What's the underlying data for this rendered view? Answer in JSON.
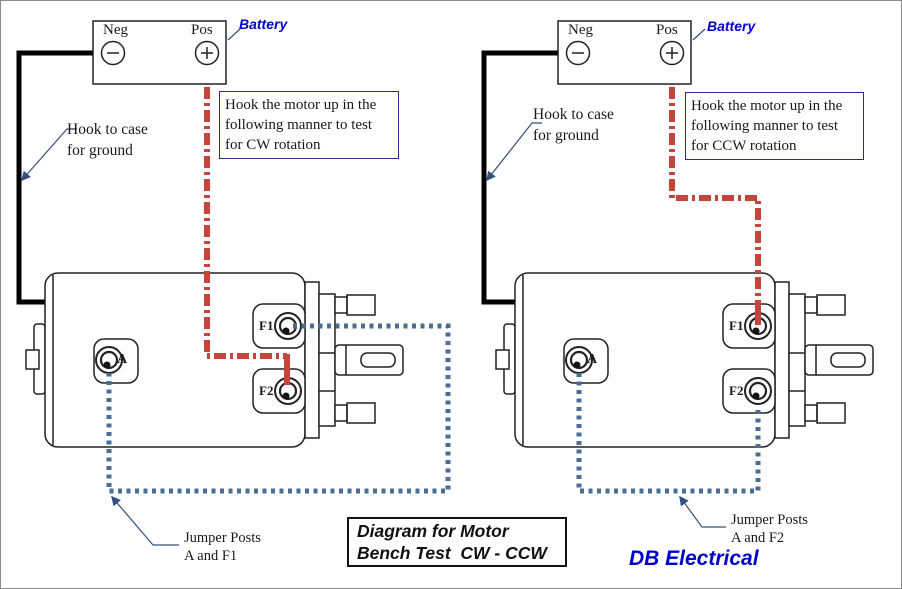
{
  "colors": {
    "wire_red": "#c2463c",
    "wire_blue": "#4a6d96",
    "wire_black": "#000000",
    "annotation_border": "#2a2a9a",
    "leader_navy": "#33507e",
    "label_blue": "#0000cc"
  },
  "title_box": {
    "line1": "Diagram for Motor",
    "line2": "Bench Test  CW - CCW"
  },
  "brand_label": "DB Electrical",
  "panels": {
    "left": {
      "battery_label": "Battery",
      "neg_label": "Neg",
      "pos_label": "Pos",
      "ground_note_line1": "Hook to case",
      "ground_note_line2": "for ground",
      "instruction_line1": "Hook the motor up in the",
      "instruction_line2": "following manner to test",
      "instruction_line3": "for CW rotation",
      "jumper_line1": "Jumper Posts",
      "jumper_line2": "A and F1",
      "terminal_a": "A",
      "terminal_f1": "F1",
      "terminal_f2": "F2"
    },
    "right": {
      "battery_label": "Battery",
      "neg_label": "Neg",
      "pos_label": "Pos",
      "ground_note_line1": "Hook to case",
      "ground_note_line2": "for ground",
      "instruction_line1": "Hook the motor up in the",
      "instruction_line2": "following manner to test",
      "instruction_line3": "for CCW rotation",
      "jumper_line1": "Jumper Posts",
      "jumper_line2": "A and F2",
      "terminal_a": "A",
      "terminal_f1": "F1",
      "terminal_f2": "F2"
    }
  }
}
